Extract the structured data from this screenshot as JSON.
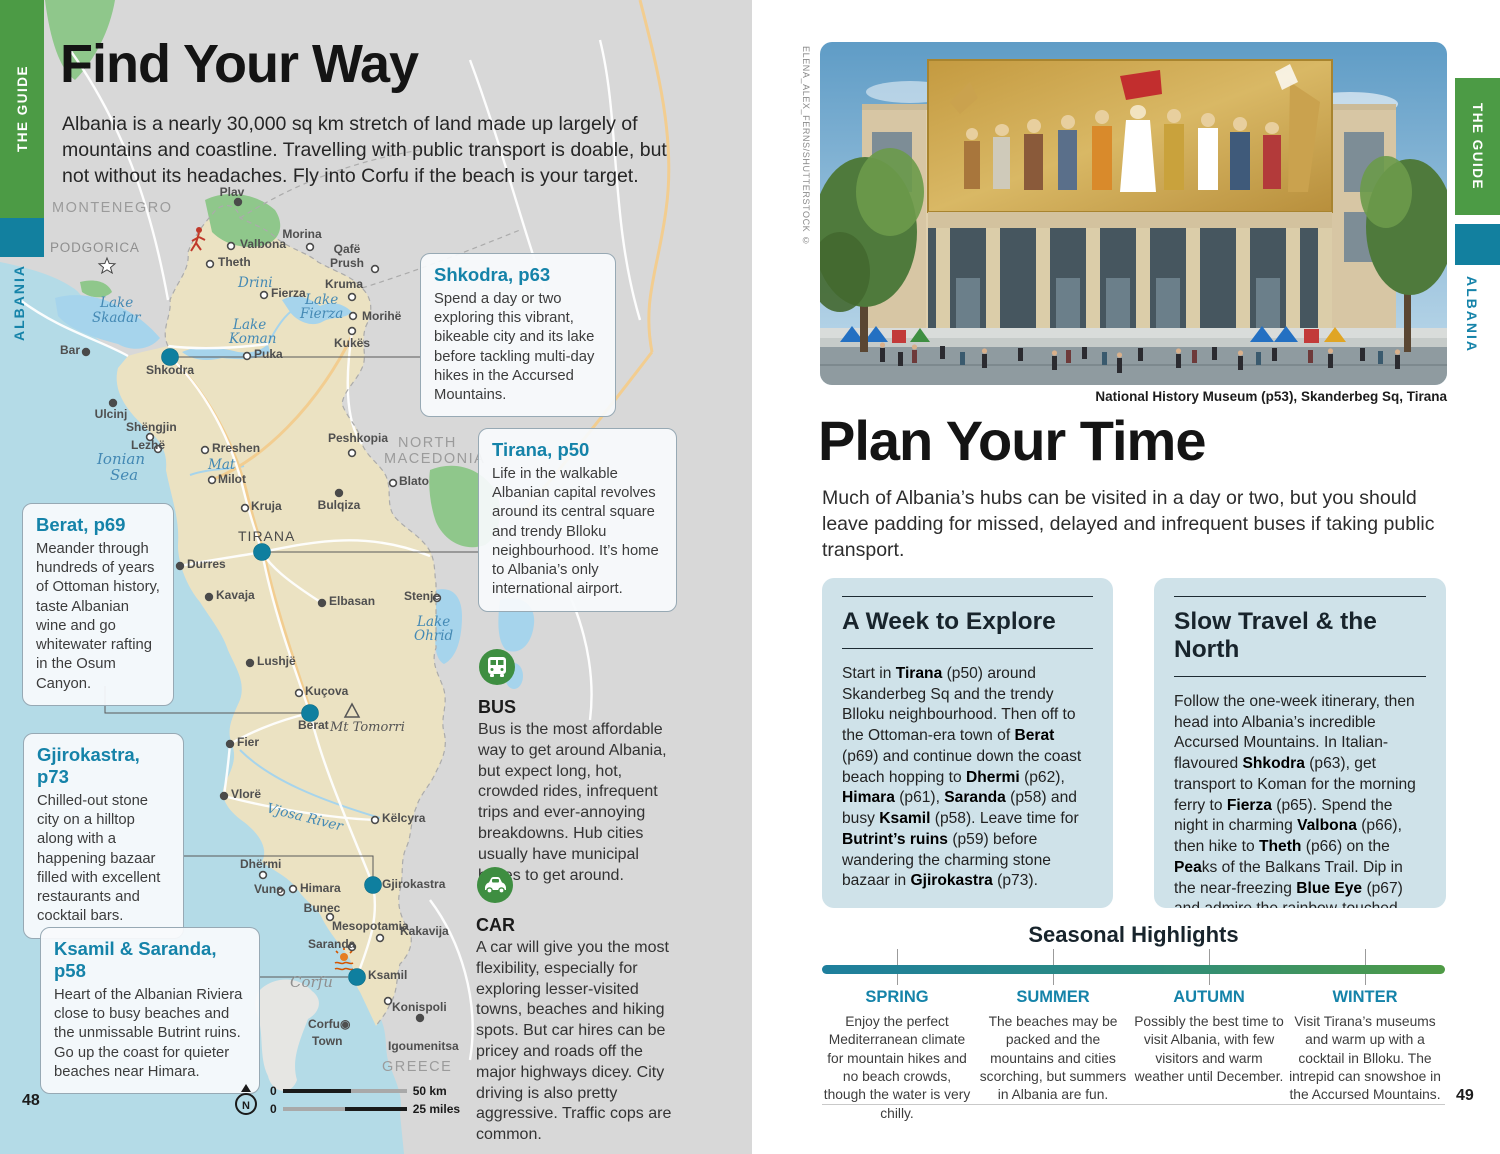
{
  "colors": {
    "accent_teal": "#1583a9",
    "band_green": "#4c9b45",
    "band_teal": "#12809f",
    "navy": "#18242c",
    "map_sea": "#b4dbe7",
    "map_land": "#ebe2c2",
    "map_other_land": "#d8d8d8",
    "map_park": "#8fc78b",
    "map_lake": "#a6d4ec",
    "highway": "#f2cd90",
    "big_dot": "#0f7f9f",
    "season_bar_from": "#1e7f9d",
    "season_bar_to": "#4f9b45"
  },
  "left": {
    "tab_guide": "THE GUIDE",
    "tab_albania": "ALBANIA",
    "page_no": "48",
    "title": "Find Your Way",
    "intro": "Albania is a nearly 30,000 sq km stretch of land made up largely of mountains and coastline. Travelling with public transport is doable, but not without its headaches. Fly into Corfu if the beach is your target.",
    "callouts": [
      {
        "title": "Shkodra, p63",
        "body": "Spend a day or two exploring this vibrant, bikeable city and its lake before tackling multi-day hikes in the Accursed Mountains."
      },
      {
        "title": "Tirana, p50",
        "body": "Life in the walkable Albanian capital revolves around its central square and trendy Blloku neighbourhood. It’s home to Albania’s only international airport."
      },
      {
        "title": "Berat, p69",
        "body": "Meander through hundreds of years of Ottoman history, taste Albanian wine and go whitewater rafting in the Osum Canyon."
      },
      {
        "title": "Gjirokastra, p73",
        "body": "Chilled-out stone city on a hilltop along with a happening bazaar filled with excellent restaurants and cocktail bars."
      },
      {
        "title": "Ksamil & Saranda, p58",
        "body": "Heart of the Albanian Riviera close to busy beaches and the unmissable Butrint ruins. Go up the coast for quieter beaches near Himara."
      }
    ],
    "transport": [
      {
        "title": "BUS",
        "body": "Bus is the most affordable way to get around Albania, but expect long, hot, crowded rides, infrequent trips and ever-annoying breakdowns. Hub cities usually have municipal buses to get around."
      },
      {
        "title": "CAR",
        "body": "A car will give you the most flexibility, especially for exploring lesser-visited towns, beaches and hiking spots. But car hires can be pricey and roads off the major highways dicey. City driving is also pretty aggressive. Traffic cops are common."
      }
    ],
    "scale": {
      "n": "N",
      "zero_km": "0",
      "zero_mi": "0",
      "km": "50 km",
      "miles": "25 miles"
    },
    "map": {
      "labels": [
        {
          "x": 52,
          "y": 212,
          "t": "MONTENEGRO",
          "c": "country"
        },
        {
          "x": 50,
          "y": 252,
          "t": "PODGORICA",
          "c": "cap"
        },
        {
          "x": 398,
          "y": 447,
          "t": "NORTH",
          "c": "country"
        },
        {
          "x": 384,
          "y": 463,
          "t": "MACEDONIA",
          "c": "country"
        },
        {
          "x": 382,
          "y": 1071,
          "t": "GREECE",
          "c": "country"
        },
        {
          "x": 238,
          "y": 541,
          "t": "TIRANA",
          "c": "caps"
        },
        {
          "x": 232,
          "y": 196,
          "t": "Plav",
          "c": "town",
          "a": "m"
        },
        {
          "x": 240,
          "y": 248,
          "t": "Valbona",
          "c": "town"
        },
        {
          "x": 218,
          "y": 266,
          "t": "Theth",
          "c": "town"
        },
        {
          "x": 302,
          "y": 238,
          "t": "Morina",
          "c": "town",
          "a": "m"
        },
        {
          "x": 347,
          "y": 253,
          "t": "Qafë",
          "c": "town",
          "a": "m"
        },
        {
          "x": 347,
          "y": 267,
          "t": "Prush",
          "c": "town",
          "a": "m"
        },
        {
          "x": 271,
          "y": 297,
          "t": "Fierza",
          "c": "town"
        },
        {
          "x": 344,
          "y": 288,
          "t": "Kruma",
          "c": "town",
          "a": "m"
        },
        {
          "x": 362,
          "y": 320,
          "t": "Morihë",
          "c": "town"
        },
        {
          "x": 352,
          "y": 347,
          "t": "Kukës",
          "c": "town",
          "a": "m"
        },
        {
          "x": 254,
          "y": 358,
          "t": "Puka",
          "c": "town"
        },
        {
          "x": 146,
          "y": 374,
          "t": "Shkodra",
          "c": "town"
        },
        {
          "x": 60,
          "y": 354,
          "t": "Bar",
          "c": "town"
        },
        {
          "x": 111,
          "y": 418,
          "t": "Ulcinj",
          "c": "town",
          "a": "m"
        },
        {
          "x": 126,
          "y": 431,
          "t": "Shëngjin",
          "c": "town"
        },
        {
          "x": 131,
          "y": 449,
          "t": "Lezhë",
          "c": "town"
        },
        {
          "x": 212,
          "y": 452,
          "t": "Rreshen",
          "c": "town"
        },
        {
          "x": 328,
          "y": 442,
          "t": "Peshkopia",
          "c": "town"
        },
        {
          "x": 218,
          "y": 483,
          "t": "Milot",
          "c": "town"
        },
        {
          "x": 399,
          "y": 485,
          "t": "Blato",
          "c": "town"
        },
        {
          "x": 251,
          "y": 510,
          "t": "Kruja",
          "c": "town"
        },
        {
          "x": 339,
          "y": 509,
          "t": "Bulqiza",
          "c": "town",
          "a": "m"
        },
        {
          "x": 187,
          "y": 568,
          "t": "Durres",
          "c": "town"
        },
        {
          "x": 216,
          "y": 599,
          "t": "Kavaja",
          "c": "town"
        },
        {
          "x": 329,
          "y": 605,
          "t": "Elbasan",
          "c": "town"
        },
        {
          "x": 404,
          "y": 600,
          "t": "Stenje",
          "c": "town"
        },
        {
          "x": 257,
          "y": 665,
          "t": "Lushjë",
          "c": "town"
        },
        {
          "x": 305,
          "y": 695,
          "t": "Kuçova",
          "c": "town"
        },
        {
          "x": 298,
          "y": 729,
          "t": "Berat",
          "c": "town"
        },
        {
          "x": 237,
          "y": 746,
          "t": "Fier",
          "c": "town"
        },
        {
          "x": 231,
          "y": 798,
          "t": "Vlorë",
          "c": "town"
        },
        {
          "x": 382,
          "y": 822,
          "t": "Këlcyra",
          "c": "town"
        },
        {
          "x": 240,
          "y": 868,
          "t": "Dhërmi",
          "c": "town"
        },
        {
          "x": 254,
          "y": 893,
          "t": "Vuno",
          "c": "town"
        },
        {
          "x": 300,
          "y": 892,
          "t": "Himara",
          "c": "town"
        },
        {
          "x": 382,
          "y": 888,
          "t": "Gjirokastra",
          "c": "town"
        },
        {
          "x": 322,
          "y": 912,
          "t": "Bunec",
          "c": "town",
          "a": "m"
        },
        {
          "x": 332,
          "y": 930,
          "t": "Mesopotamia",
          "c": "town"
        },
        {
          "x": 308,
          "y": 948,
          "t": "Saranda",
          "c": "town"
        },
        {
          "x": 400,
          "y": 935,
          "t": "Kakavija",
          "c": "town"
        },
        {
          "x": 368,
          "y": 979,
          "t": "Ksamil",
          "c": "town"
        },
        {
          "x": 392,
          "y": 1011,
          "t": "Konispoli",
          "c": "town"
        },
        {
          "x": 308,
          "y": 1028,
          "t": "Corfu◉",
          "c": "town"
        },
        {
          "x": 312,
          "y": 1045,
          "t": "Town",
          "c": "town"
        },
        {
          "x": 388,
          "y": 1050,
          "t": "Igoumenitsa",
          "c": "town"
        },
        {
          "x": 100,
          "y": 307,
          "t": "Lake",
          "c": "water"
        },
        {
          "x": 92,
          "y": 322,
          "t": "Skadar",
          "c": "water"
        },
        {
          "x": 238,
          "y": 287,
          "t": "Drini",
          "c": "water"
        },
        {
          "x": 305,
          "y": 304,
          "t": "Lake",
          "c": "water"
        },
        {
          "x": 300,
          "y": 318,
          "t": "Fierza",
          "c": "water"
        },
        {
          "x": 233,
          "y": 329,
          "t": "Lake",
          "c": "water"
        },
        {
          "x": 229,
          "y": 343,
          "t": "Koman",
          "c": "water"
        },
        {
          "x": 208,
          "y": 469,
          "t": "Mat",
          "c": "water"
        },
        {
          "x": 417,
          "y": 626,
          "t": "Lake",
          "c": "water"
        },
        {
          "x": 414,
          "y": 640,
          "t": "Ohrid",
          "c": "water"
        },
        {
          "x": 97,
          "y": 464,
          "t": "Ionian",
          "c": "sea"
        },
        {
          "x": 110,
          "y": 480,
          "t": "Sea",
          "c": "sea"
        },
        {
          "x": 266,
          "y": 812,
          "t": "Vjosa River",
          "c": "water",
          "r": 14
        },
        {
          "x": 290,
          "y": 987,
          "t": "Corfu",
          "c": "region"
        },
        {
          "x": 330,
          "y": 731,
          "t": "Mt Tomorri",
          "c": "peak"
        }
      ],
      "towns": [
        [
          170,
          357,
          "b"
        ],
        [
          262,
          552,
          "b"
        ],
        [
          310,
          713,
          "b"
        ],
        [
          373,
          885,
          "b"
        ],
        [
          357,
          977,
          "b"
        ],
        [
          238,
          202,
          "d"
        ],
        [
          86,
          352,
          "d"
        ],
        [
          113,
          403,
          "d"
        ],
        [
          180,
          566,
          "d"
        ],
        [
          209,
          597,
          "d"
        ],
        [
          322,
          603,
          "d"
        ],
        [
          250,
          663,
          "d"
        ],
        [
          230,
          744,
          "d"
        ],
        [
          224,
          796,
          "d"
        ],
        [
          339,
          493,
          "d"
        ],
        [
          420,
          1018,
          "d"
        ],
        [
          231,
          246,
          "r"
        ],
        [
          210,
          264,
          "r"
        ],
        [
          310,
          247,
          "r"
        ],
        [
          375,
          269,
          "r"
        ],
        [
          264,
          295,
          "r"
        ],
        [
          352,
          297,
          "r"
        ],
        [
          353,
          316,
          "r"
        ],
        [
          352,
          331,
          "r"
        ],
        [
          247,
          356,
          "r"
        ],
        [
          150,
          437,
          "r"
        ],
        [
          158,
          449,
          "r"
        ],
        [
          205,
          450,
          "r"
        ],
        [
          352,
          453,
          "r"
        ],
        [
          212,
          480,
          "r"
        ],
        [
          393,
          483,
          "r"
        ],
        [
          245,
          508,
          "r"
        ],
        [
          437,
          598,
          "r"
        ],
        [
          299,
          693,
          "r"
        ],
        [
          375,
          820,
          "r"
        ],
        [
          263,
          875,
          "r"
        ],
        [
          281,
          892,
          "r"
        ],
        [
          293,
          889,
          "r"
        ],
        [
          330,
          917,
          "r"
        ],
        [
          380,
          938,
          "r"
        ],
        [
          352,
          947,
          "r"
        ],
        [
          388,
          1001,
          "r"
        ]
      ],
      "connectors": [
        "178,357 420,357",
        "270,552 478,552",
        "105,686 105,713 302,713",
        "184,856 373,856 373,877",
        "260,977 348,977"
      ]
    }
  },
  "right": {
    "tab_guide": "THE GUIDE",
    "tab_albania": "ALBANIA",
    "page_no": "49",
    "credit": "ELENA_ALEX_FERNS/SHUTTERSTOCK ©",
    "caption": "National History Museum (p53), Skanderbeg Sq, Tirana",
    "title": "Plan Your Time",
    "intro": "Much of Albania’s hubs can be visited in a day or two, but you should leave padding for missed, delayed and infrequent buses if taking public transport.",
    "boxes": [
      {
        "title": "A Week to Explore",
        "segments": [
          {
            "t": "Start in "
          },
          {
            "t": "Tirana",
            "b": 1
          },
          {
            "t": " (p50) around Skanderbeg Sq and the trendy Blloku neighbourhood. Then off to the Ottoman-era town of "
          },
          {
            "t": "Berat",
            "b": 1
          },
          {
            "t": " (p69) and continue down the coast beach hopping to "
          },
          {
            "t": "Dhermi",
            "b": 1
          },
          {
            "t": " (p62), "
          },
          {
            "t": "Himara",
            "b": 1
          },
          {
            "t": " (p61), "
          },
          {
            "t": "Saranda",
            "b": 1
          },
          {
            "t": " (p58) and busy "
          },
          {
            "t": "Ksamil",
            "b": 1
          },
          {
            "t": " (p58). Leave time for "
          },
          {
            "t": "Butrint’s ruins",
            "b": 1
          },
          {
            "t": " (p59) before wandering the charming stone bazaar in "
          },
          {
            "t": "Gjirokastra",
            "b": 1
          },
          {
            "t": " (p73)."
          }
        ]
      },
      {
        "title": "Slow Travel & the North",
        "segments": [
          {
            "t": "Follow the one-week itinerary, then head into Albania’s incredible Accursed Mountains. In Italian-flavoured "
          },
          {
            "t": "Shkodra",
            "b": 1
          },
          {
            "t": " (p63), get transport to Koman for the morning ferry to "
          },
          {
            "t": "Fierza",
            "b": 1
          },
          {
            "t": " (p65). Spend the night in charming "
          },
          {
            "t": "Valbona",
            "b": 1
          },
          {
            "t": " (p66), then hike to "
          },
          {
            "t": "Theth",
            "b": 1
          },
          {
            "t": " (p66) on the "
          },
          {
            "t": "Pea",
            "b": 1
          },
          {
            "t": "ks of the Balkans Trail. Dip in the near-freezing "
          },
          {
            "t": "Blue Eye",
            "b": 1
          },
          {
            "t": " (p67) and admire the rainbow-touched waterfall."
          }
        ]
      }
    ],
    "seasonal": {
      "title": "Seasonal Highlights",
      "seasons": [
        {
          "name": "SPRING",
          "body": "Enjoy the perfect Mediterranean climate for mountain hikes and no beach crowds, though the water is very chilly."
        },
        {
          "name": "SUMMER",
          "body": "The beaches may be packed and the mountains and cities scorching, but summers in Albania are fun."
        },
        {
          "name": "AUTUMN",
          "body": "Possibly the best time to visit Albania, with few visitors and warm weather until December."
        },
        {
          "name": "WINTER",
          "body": "Visit Tirana’s museums and warm up with a cocktail in Blloku. The intrepid can snowshoe in the Accursed Mountains."
        }
      ]
    }
  }
}
